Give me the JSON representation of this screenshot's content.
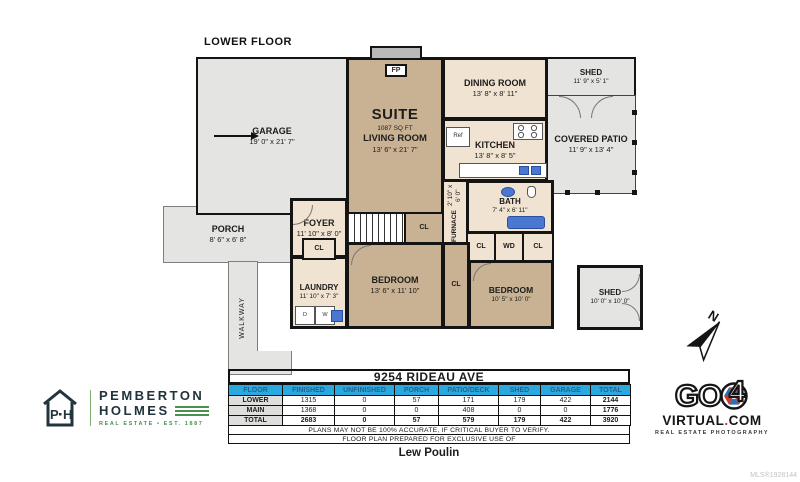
{
  "floor_label": "LOWER FLOOR",
  "compass": {
    "north_label": "N"
  },
  "rooms": {
    "garage": {
      "name": "GARAGE",
      "dims": "19' 0\" x 21' 7\""
    },
    "suite": {
      "name": "SUITE",
      "area": "1087 SQ FT",
      "subname": "LIVING ROOM",
      "dims": "13' 6\" x 21' 7\""
    },
    "dining": {
      "name": "DINING ROOM",
      "dims": "13' 8\" x 8' 11\""
    },
    "kitchen": {
      "name": "KITCHEN",
      "dims": "13' 8\" x 8' 5\""
    },
    "shed_upper": {
      "name": "SHED",
      "dims": "11' 9\" x 5' 1\""
    },
    "covered_patio": {
      "name": "COVERED PATIO",
      "dims": "11' 9\" x 13' 4\""
    },
    "bath": {
      "name": "BATH",
      "dims": "7' 4\" x 6' 11\""
    },
    "furnace": {
      "name": "FURNACE",
      "dims": "2' 10\" x 6' 0\""
    },
    "porch": {
      "name": "PORCH",
      "dims": "8' 6\" x 6' 8\""
    },
    "foyer": {
      "name": "FOYER",
      "dims": "11' 10\" x 8' 0\""
    },
    "laundry": {
      "name": "LAUNDRY",
      "dims": "11' 10\" x 7' 3\""
    },
    "walkway": {
      "name": "WALKWAY"
    },
    "bedroom1": {
      "name": "BEDROOM",
      "dims": "13' 6\" x 11' 10\""
    },
    "bedroom2": {
      "name": "BEDROOM",
      "dims": "10' 5\" x 10' 0\""
    },
    "shed_lower": {
      "name": "SHED",
      "dims": "10' 0\" x 10' 0\""
    }
  },
  "fixtures": {
    "fireplace": "FP",
    "closet": "CL",
    "washer_dryer": "WD",
    "dryer": "D",
    "washer": "W",
    "fridge": "Ref"
  },
  "summary": {
    "address": "9254 RIDEAU AVE",
    "headers": [
      "FLOOR",
      "FINISHED",
      "UNFINISHED",
      "PORCH",
      "PATIO/DECK",
      "SHED",
      "GARAGE",
      "TOTAL"
    ],
    "rows": [
      {
        "floor": "LOWER",
        "values": [
          "1315",
          "0",
          "57",
          "171",
          "179",
          "422",
          "2144"
        ]
      },
      {
        "floor": "MAIN",
        "values": [
          "1368",
          "0",
          "0",
          "408",
          "0",
          "0",
          "1776"
        ]
      },
      {
        "floor": "TOTAL",
        "values": [
          "2683",
          "0",
          "57",
          "579",
          "179",
          "422",
          "3920"
        ]
      }
    ],
    "disclaimer1": "PLANS MAY NOT BE 100% ACCURATE, IF CRITICAL BUYER TO VERIFY.",
    "disclaimer2": "FLOOR PLAN PREPARED FOR EXCLUSIVE USE OF",
    "prepared_for": "Lew Poulin"
  },
  "branding": {
    "pemberton": {
      "monogram_left": "P",
      "monogram_right": "H",
      "line1": "PEMBERTON",
      "line2": "HOLMES",
      "tagline": "REAL ESTATE  •  EST. 1887"
    },
    "go4": {
      "go": "GO",
      "four": "4",
      "domain_left": "VIRTUAL",
      "domain_dot": ".",
      "domain_right": "COM",
      "tagline": "REAL ESTATE PHOTOGRAPHY"
    },
    "mls": "MLS®1928144"
  },
  "colors": {
    "wall": "#141414",
    "finished_tan": "#c9b293",
    "finished_beige": "#f0e3d1",
    "unfinished_gray": "#e4e4e2",
    "table_header_blue": "#29a9e0",
    "fixture_blue": "#4a78d0",
    "pemberton_green": "#4a9150",
    "go4_red": "#c8392e",
    "go4_blue": "#2b6fb3"
  }
}
